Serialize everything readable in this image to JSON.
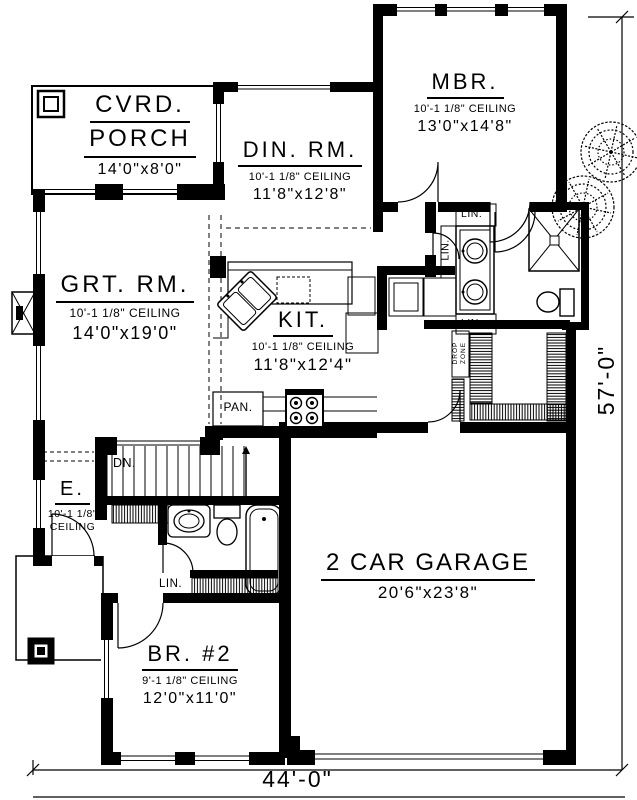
{
  "rooms": {
    "porch": {
      "name_line1": "CVRD.",
      "name_line2": "PORCH",
      "size": "14'0\"x8'0\""
    },
    "dining": {
      "name": "DIN. RM.",
      "ceiling": "10'-1 1/8\" CEILING",
      "size": "11'8\"x12'8\""
    },
    "master": {
      "name": "MBR.",
      "ceiling": "10'-1 1/8\" CEILING",
      "size": "13'0\"x14'8\""
    },
    "great": {
      "name": "GRT. RM.",
      "ceiling": "10'-1 1/8\" CEILING",
      "size": "14'0\"x19'0\""
    },
    "kitchen": {
      "name": "KIT.",
      "ceiling": "10'-1 1/8\" CEILING",
      "size": "11'8\"x12'4\""
    },
    "entry": {
      "name": "E.",
      "ceiling_line1": "10'-1 1/8\"",
      "ceiling_line2": "CEILING"
    },
    "bedroom2": {
      "name": "BR. #2",
      "ceiling": "9'-1 1/8\" CEILING",
      "size": "12'0\"x11'0\""
    },
    "garage": {
      "name": "2 CAR GARAGE",
      "size": "20'6\"x23'8\""
    }
  },
  "labels": {
    "pantry": "PAN.",
    "down": "DN.",
    "linen": "LIN.",
    "drop_line1": "DROP",
    "drop_line2": "ZONE"
  },
  "dimensions": {
    "overall_width": "44'-0\"",
    "overall_depth": "57'-0\""
  },
  "colors": {
    "ink": "#000000",
    "paper": "#ffffff"
  }
}
